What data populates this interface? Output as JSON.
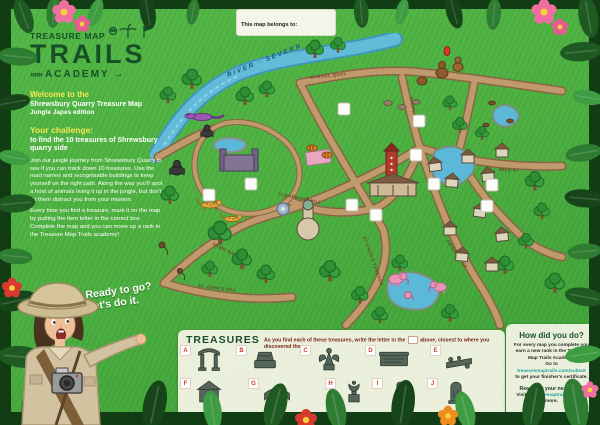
{
  "poster": {
    "belongs_to_label": "This map belongs to:"
  },
  "logo": {
    "top": "TREASURE MAP",
    "title": "TRAILS",
    "academy": "ACADEMY",
    "arrows_left": "»»»",
    "arrow_right": "→"
  },
  "intro": {
    "welcome": "Welcome to the",
    "line1": "Shrewsbury Quarry Treasure Map",
    "line2": "Jungle Japes edition"
  },
  "challenge": {
    "heading": "Your challenge:",
    "subheading": "to find the 10 treasures of Shrewsbury quarry side",
    "para1": "Join our jungle journey from Shrewsbury Quarry to see if you can track down 10 treasures. Use the road names and recognisable buildings to keep yourself on the right path. Along the way you'll spot a host of animals living it up in the jungle, but don't let them distract you from your mission.",
    "para2": "Every time you find a treasure, mark it on the map by putting the item letter in the correct box. Complete the map and you can move up a rank in the Treasure Map Trails academy!"
  },
  "cta": {
    "line1": "Ready to go?",
    "line2": "Let's do it."
  },
  "map": {
    "river_label": "RIVER · SEVERN",
    "roads": [
      "MARDOL QUAY",
      "SHOPLATCH",
      "MARKET ST",
      "MILK ST",
      "PRINCESS ST",
      "CLAREMONT HILL",
      "ST CHAD'S TERRACE",
      "TOWN WALLS",
      "ST JOHN'S HILL"
    ],
    "answer_box_count": 10
  },
  "treasures": {
    "heading": "TREASURES",
    "instruction_pre": "As you find each of these treasures, write the letter in the",
    "instruction_post": "above, closest to where you discovered them.",
    "letters": [
      "A",
      "B",
      "C",
      "D",
      "E",
      "F",
      "G",
      "H",
      "I",
      "J"
    ]
  },
  "how": {
    "title": "How did you do?",
    "body1": "For every map you complete you earn a new rank in the Treasure Map Trails Academy.",
    "goto": "Go to",
    "link1": "treasuremaptrails.com/submit",
    "body2": "to get your finisher's certificate.",
    "next": "Ready for your next map?",
    "visit": "Visit",
    "link2": "treasuremaptrails.com",
    "more": "for more.",
    "copyright": "© 2020 Treasure Map Trails"
  },
  "colors": {
    "sheet_green": "#4fb243",
    "jungle_dark": "#16421a",
    "banner_cream": "#f1f3e3",
    "letter_red": "#d13b27",
    "link_teal": "#1fa39c",
    "heading_yellow": "#f3e84f",
    "logo_green": "#175026",
    "road_tan": "#c09a6d",
    "river_blue": "#62bbd9"
  }
}
